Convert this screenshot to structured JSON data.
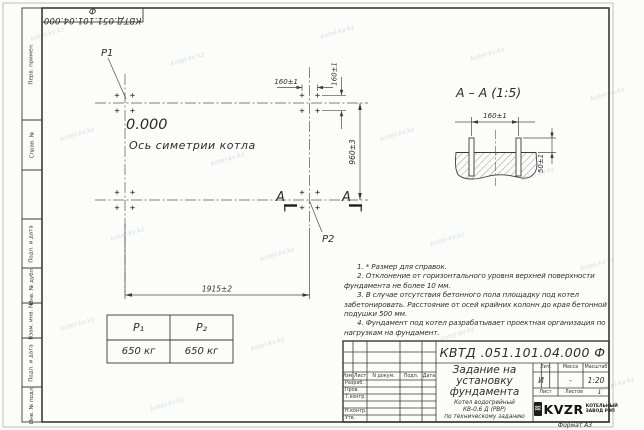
{
  "watermark": {
    "text": "kotel-kv.kz"
  },
  "frame": {
    "designation_top": "КВТД.051.101.04.000 Ф",
    "left_labels": [
      "Перв. примен.",
      "Справ. №",
      "Подп. и дата",
      "Инв. № дубл.",
      "Взам. инв. №",
      "Подп. и дата",
      "Инв. № подл."
    ],
    "format_note": "Формат А3"
  },
  "plan": {
    "p1": "P1",
    "p2": "P2",
    "elevation": "0.000",
    "axis_label": "Ось симетрии котла",
    "dim_width": "1915±2",
    "dim_height": "960±3",
    "dim_bolt_x": "160±1",
    "dim_bolt_y": "160±1",
    "section_letter": "А"
  },
  "section_view": {
    "title": "А – А  (1:5)",
    "dim_span": "160±1",
    "dim_protrusion": "50±1"
  },
  "loads_table": {
    "col1_header": "P₁",
    "col2_header": "P₂",
    "col1_value": "650 кг",
    "col2_value": "650 кг"
  },
  "notes": [
    "1. * Размер для справок.",
    "2. Отклонение от горизонтального уровня верхней поверхности фундамента не более 10 мм.",
    "3. В случае отсутствия бетонного пола площадку под котел забетонировать. Расстояние от осей крайних колонн до края бетонной подушки 500 мм.",
    "4. Фундамент под котел разрабатывает проектная организация по нагрузкам на фундамент."
  ],
  "title_block": {
    "designation": "КВТД .051.101.04.000  Ф",
    "header_cells": [
      "Изм.",
      "Лист",
      "N докум.",
      "Подп.",
      "Дата"
    ],
    "roles": [
      "Разраб.",
      "Пров.",
      "Т.контр.",
      "Н.контр.",
      "Утв."
    ],
    "title_lines": [
      "Задание на",
      "установку",
      "фундамента"
    ],
    "subtitle_lines": [
      "Котел водогрейный",
      "КВ-0,6 Д (РВР)",
      "по техническому заданию"
    ],
    "lit_header": "Лит.",
    "lit_value": "И",
    "mass_header": "Масса",
    "mass_value": "-",
    "scale_header": "Масштаб",
    "scale_value": "1:20",
    "sheet_label": "Лист",
    "sheets_label": "Листов",
    "sheets_value": "1",
    "company_logo": "KVZR",
    "company_line1": "КОТЕЛЬНЫЙ",
    "company_line2": "ЗАВОД РЭП",
    "logo_glyph": "≋"
  }
}
